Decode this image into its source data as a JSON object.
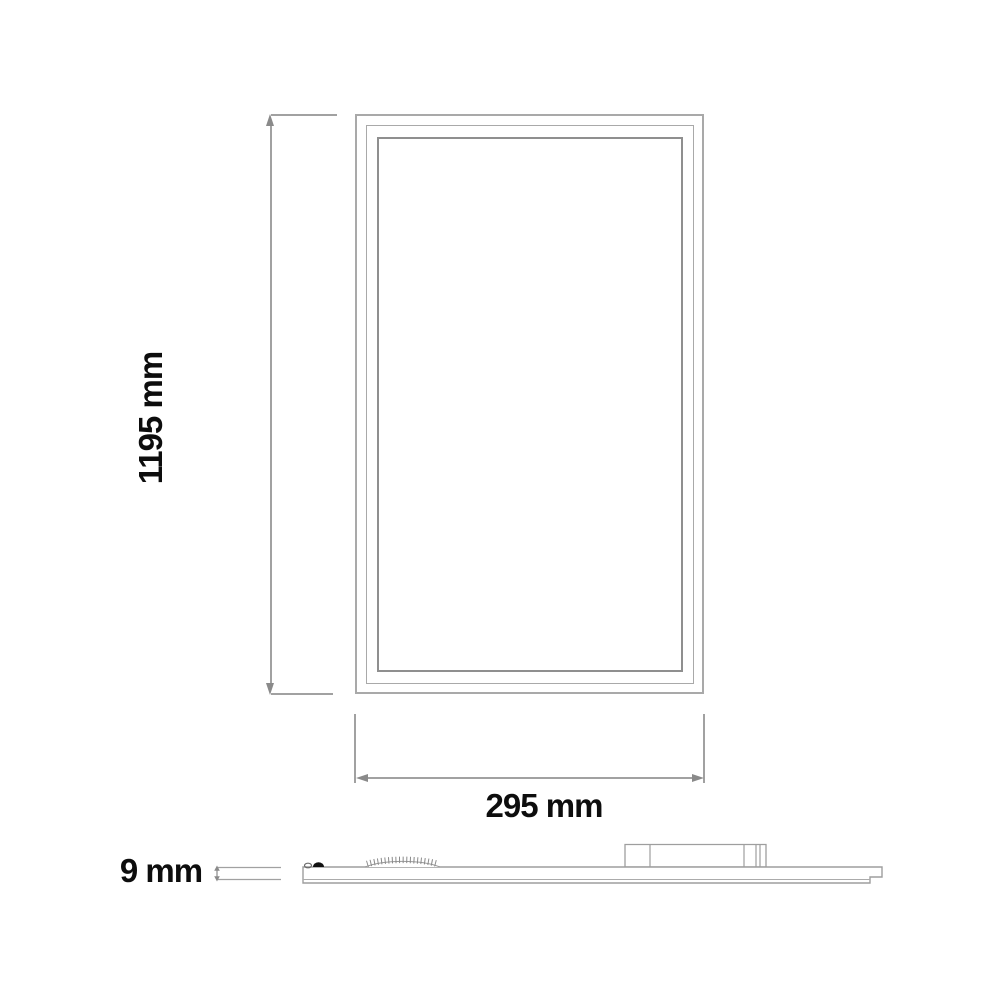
{
  "drawing": {
    "views": {
      "front": {
        "name": "panel front view"
      },
      "side": {
        "name": "panel side profile view"
      }
    }
  },
  "dimensions": {
    "height": {
      "label": "1195 mm",
      "value": 1195,
      "unit": "mm"
    },
    "width": {
      "label": "295 mm",
      "value": 295,
      "unit": "mm"
    },
    "thickness": {
      "label": "9 mm",
      "value": 9,
      "unit": "mm"
    }
  },
  "colors": {
    "background": "#ffffff",
    "frame_outline": "#a9a9a9",
    "inner_frame_outline": "#8f8f8f",
    "dimension_line": "#a1a1a1",
    "arrowhead": "#8a8a8a",
    "label_text": "#0d0d0d",
    "clip_fill": "#111111"
  },
  "icons": {
    "arrow_up": "arrowhead pointing up",
    "arrow_down": "arrowhead pointing down",
    "arrow_left": "arrowhead pointing left",
    "arrow_right": "arrowhead pointing right"
  }
}
